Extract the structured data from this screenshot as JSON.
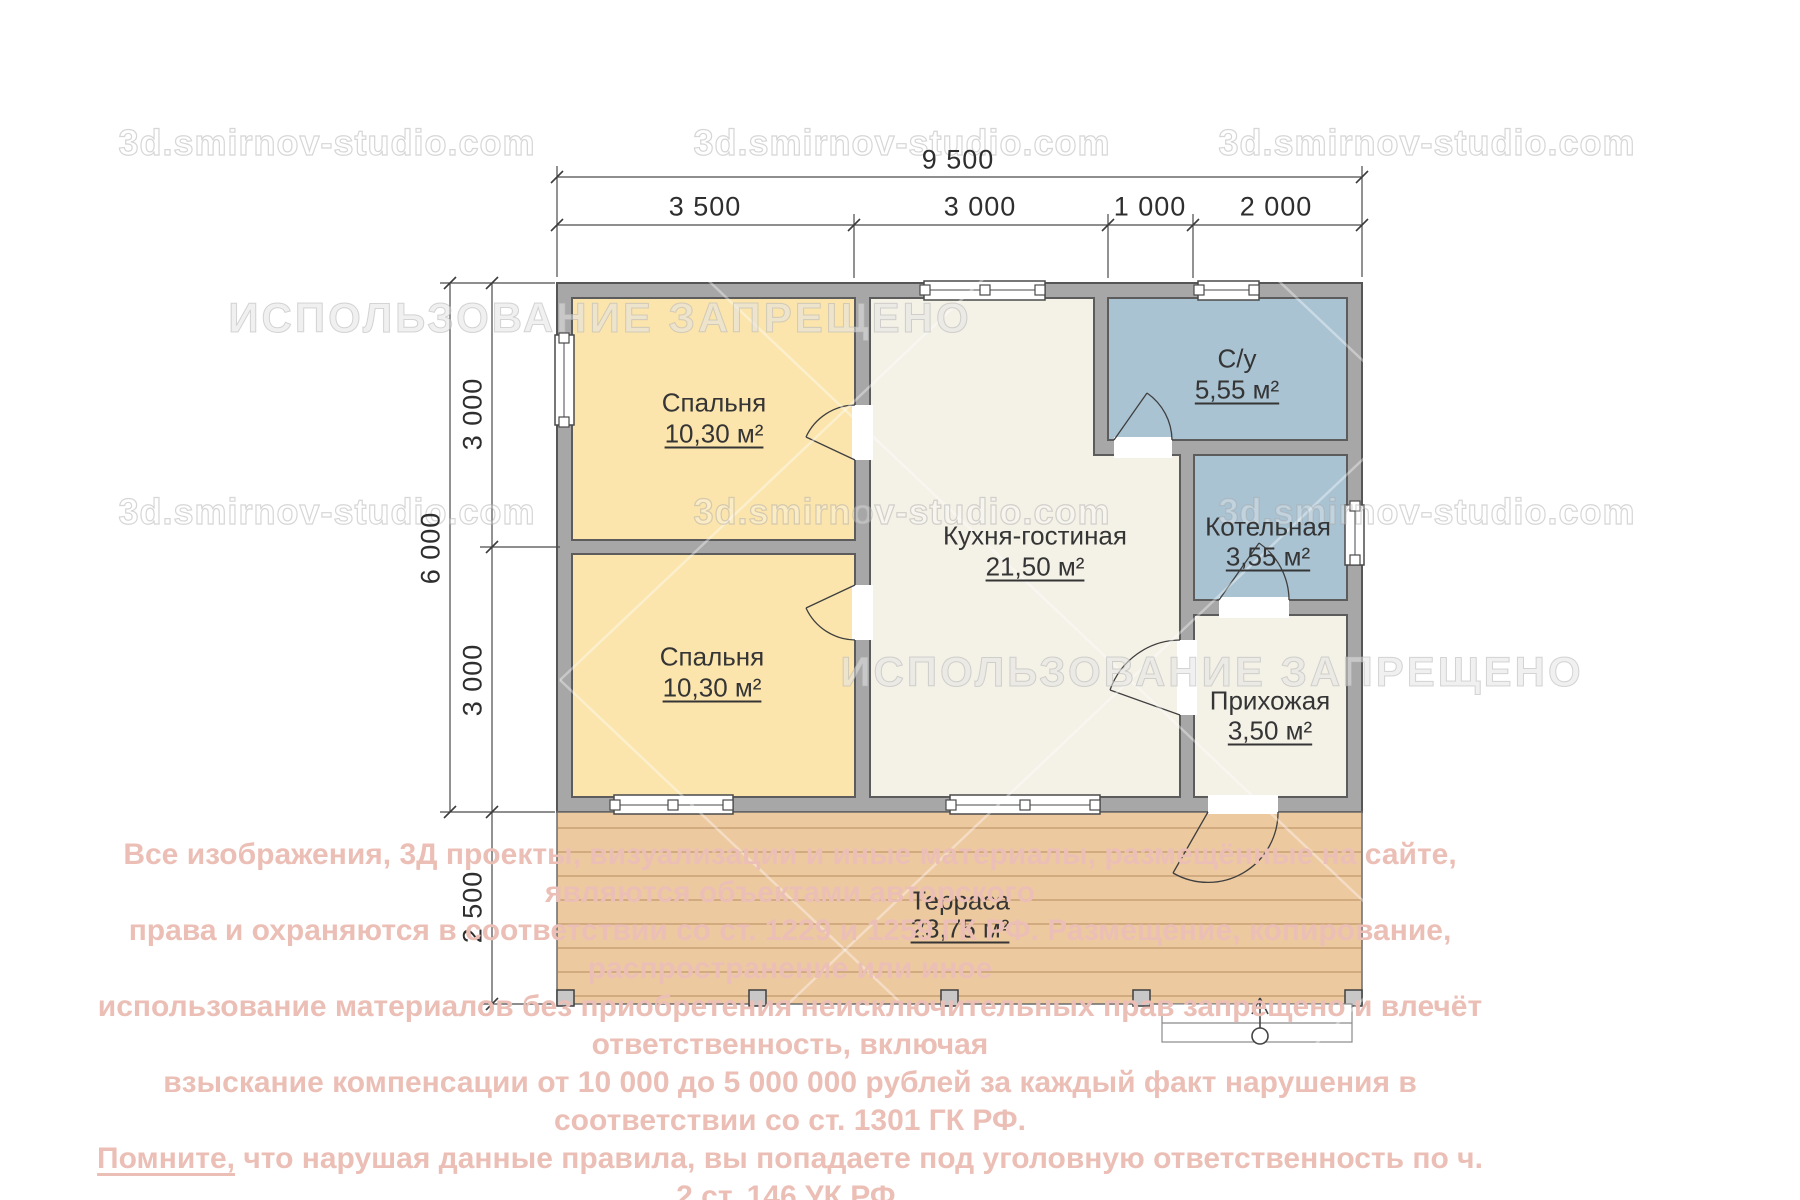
{
  "watermarks": {
    "site": "3d.smirnov-studio.com",
    "forbidden": "ИСПОЛЬЗОВАНИЕ ЗАПРЕЩЕНО"
  },
  "dimensions": {
    "total_width": "9 500",
    "top_segments": [
      "3 500",
      "3 000",
      "1 000",
      "2 000"
    ],
    "total_height": "6 000",
    "left_segments": [
      "3 000",
      "3 000"
    ],
    "terrace_depth": "2 500"
  },
  "rooms": [
    {
      "name": "Спальня",
      "area": "10,30 м²"
    },
    {
      "name": "Спальня",
      "area": "10,30 м²"
    },
    {
      "name": "Кухня-гостиная",
      "area": "21,50 м²"
    },
    {
      "name": "С/у",
      "area": "5,55 м²"
    },
    {
      "name": "Котельная",
      "area": "3,55 м²"
    },
    {
      "name": "Прихожая",
      "area": "3,50 м²"
    },
    {
      "name": "Терраса",
      "area": "23,75 м²"
    }
  ],
  "colors": {
    "bedroom_fill": "#fbe5ad",
    "living_fill": "#f4f1e7",
    "wet_room_fill": "#a9c3d3",
    "wall_fill": "#a7a7a7",
    "terrace_fill": "#edc9a0",
    "copyright_text": "#ecbfb6"
  },
  "copyright": {
    "line1": "Все изображения, 3Д проекты, визуализации и иные материалы, размещённые на сайте, являются объектами авторского",
    "line2": "права и охраняются в соответствии со ст. 1229 и 1259 ГК РФ. Размещение, копирование, распространение или иное",
    "line3": "использование материалов без приобретения неисключительных прав запрещено и влечёт ответственность, включая",
    "line4": "взыскание компенсации от 10 000 до 5 000 000 рублей за каждый факт нарушения в соответствии со ст. 1301 ГК РФ.",
    "line5_lead": "Помните,",
    "line5_rest": " что нарушая данные правила, вы попадаете под уголовную ответственность по ч. 2 ст. 146 УК РФ."
  }
}
